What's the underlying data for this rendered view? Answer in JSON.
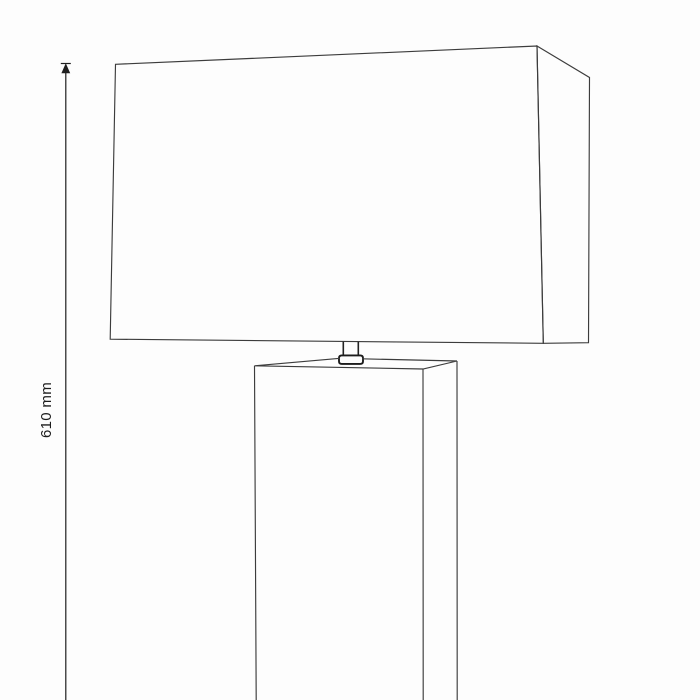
{
  "page": {
    "background": "#fdfdfd",
    "description": "Technical line drawing of a table lamp with rectangular shade and square column base, with overall height dimension"
  },
  "dimension": {
    "label": "610 mm",
    "line_color": "#1f1f1f",
    "line_d": "M65.8,72.5 L65.8,700",
    "arrow_tick_d": "M60.8,63.5 L70.8,63.5",
    "arrow_head_d": "M65.8,64.2 L62,72.8 L69.6,72.8 Z"
  },
  "lamp": {
    "line_color": "#3c3c3c",
    "shade": {
      "front_face_d": "M115.5,64.3 L537,46 L543.3,343.3 L110.2,339.2 Z",
      "side_face_d": "M537,46 L589.5,77.5 L588.5,342.7 L543.3,343.3 Z"
    },
    "neck": {
      "stem_d": "M343.3,341.6 L343.3,356 M358.3,341.7 L358.3,356",
      "collar_d": "M341.8,355.4 L360.2,355.4 Q363,355.4 363,358.1 L363,361.2 Q363,363.9 360.2,363.9 L341.8,363.9 Q339,363.9 339,361.2 L339,358.1 Q339,355.4 341.8,355.4 Z"
    },
    "base": {
      "top_face_d": "M254.5,365.8 L423,369 L457,361 M254.5,365.8 L340,358.3 M362,358.8 L457,361",
      "column_edges_d": "M254.5,365.8 L256.2,700 M423,369 L423.2,700 M457,361 L457.2,700"
    }
  }
}
